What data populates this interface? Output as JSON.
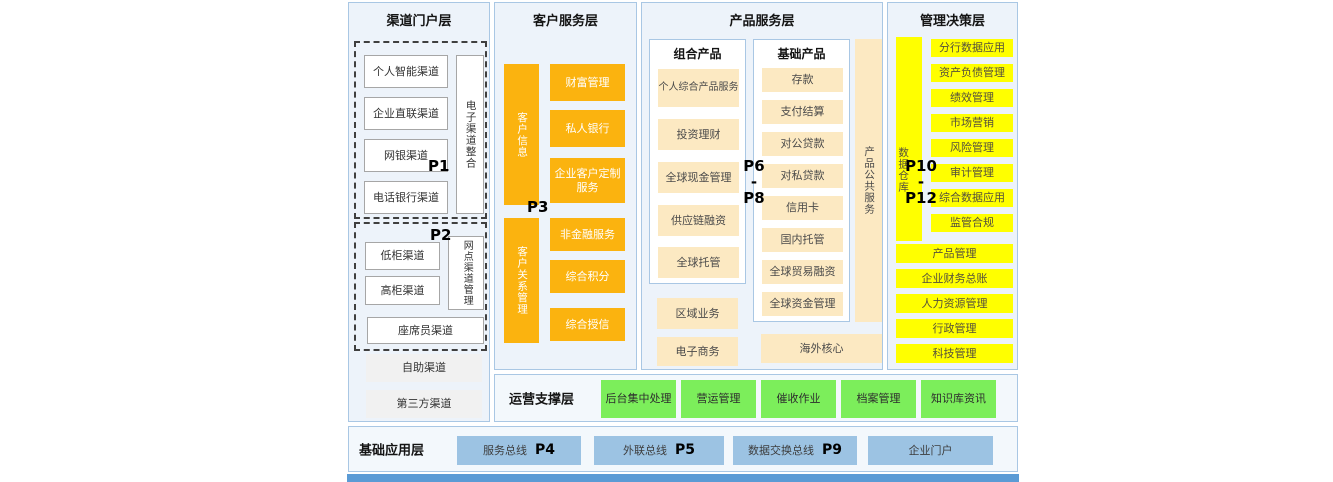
{
  "colors": {
    "panel_bg": "#EDF3FA",
    "panel_border": "#A9C7E4",
    "orange": "#FBB30F",
    "cream": "#FCE9C2",
    "yellow": "#FFFF00",
    "green": "#7CEE5B",
    "blue_button": "#9CC3E3",
    "bottom_strip": "#5B9BD5"
  },
  "layers": {
    "channel": {
      "title": "渠道门户层",
      "p1_label": "P1",
      "p1_boxes": [
        "个人智能渠道",
        "企业直联渠道",
        "网银渠道",
        "电话银行渠道"
      ],
      "p1_vertical": "电子渠道整合",
      "p2_label": "P2",
      "p2_boxes": [
        "低柜渠道",
        "高柜渠道"
      ],
      "p2_vertical": "网点渠道管理",
      "p2_wide": "座席员渠道",
      "bottom_boxes": [
        "自助渠道",
        "第三方渠道"
      ]
    },
    "customer": {
      "title": "客户服务层",
      "p3_label": "P3",
      "bar1": "客户信息",
      "bar2": "客户关系管理",
      "boxes_top": [
        "财富管理",
        "私人银行",
        "企业客户定制服务"
      ],
      "boxes_bottom": [
        "非金融服务",
        "综合积分",
        "综合授信"
      ]
    },
    "product": {
      "title": "产品服务层",
      "p_label": {
        "top": "P6",
        "mid": "-",
        "bottom": "P8"
      },
      "combo": {
        "title": "组合产品",
        "items": [
          "个人综合产品服务",
          "投资理财",
          "全球现金管理",
          "供应链融资",
          "全球托管"
        ]
      },
      "combo_extra": [
        "区域业务",
        "电子商务"
      ],
      "basic": {
        "title": "基础产品",
        "items": [
          "存款",
          "支付结算",
          "对公贷款",
          "对私贷款",
          "信用卡",
          "国内托管",
          "全球贸易融资",
          "全球资金管理"
        ]
      },
      "vertical": "产品公共服务",
      "overseas": "海外核心"
    },
    "management": {
      "title": "管理决策层",
      "p_label": {
        "top": "P10",
        "mid": "-",
        "bottom": "P12"
      },
      "vertical": "数据仓库",
      "narrow_boxes": [
        "分行数据应用",
        "资产负债管理",
        "绩效管理",
        "市场营销",
        "风险管理",
        "审计管理",
        "综合数据应用",
        "监管合规"
      ],
      "wide_boxes": [
        "产品管理",
        "企业财务总账",
        "人力资源管理",
        "行政管理",
        "科技管理"
      ]
    },
    "operation": {
      "title": "运营支撑层",
      "boxes": [
        "后台集中处理",
        "营运管理",
        "催收作业",
        "档案管理",
        "知识库资讯"
      ]
    },
    "foundation": {
      "title": "基础应用层",
      "buses": [
        {
          "label": "服务总线",
          "p": "P4"
        },
        {
          "label": "外联总线",
          "p": "P5"
        },
        {
          "label": "数据交换总线",
          "p": "P9"
        },
        {
          "label": "企业门户",
          "p": ""
        }
      ]
    }
  }
}
